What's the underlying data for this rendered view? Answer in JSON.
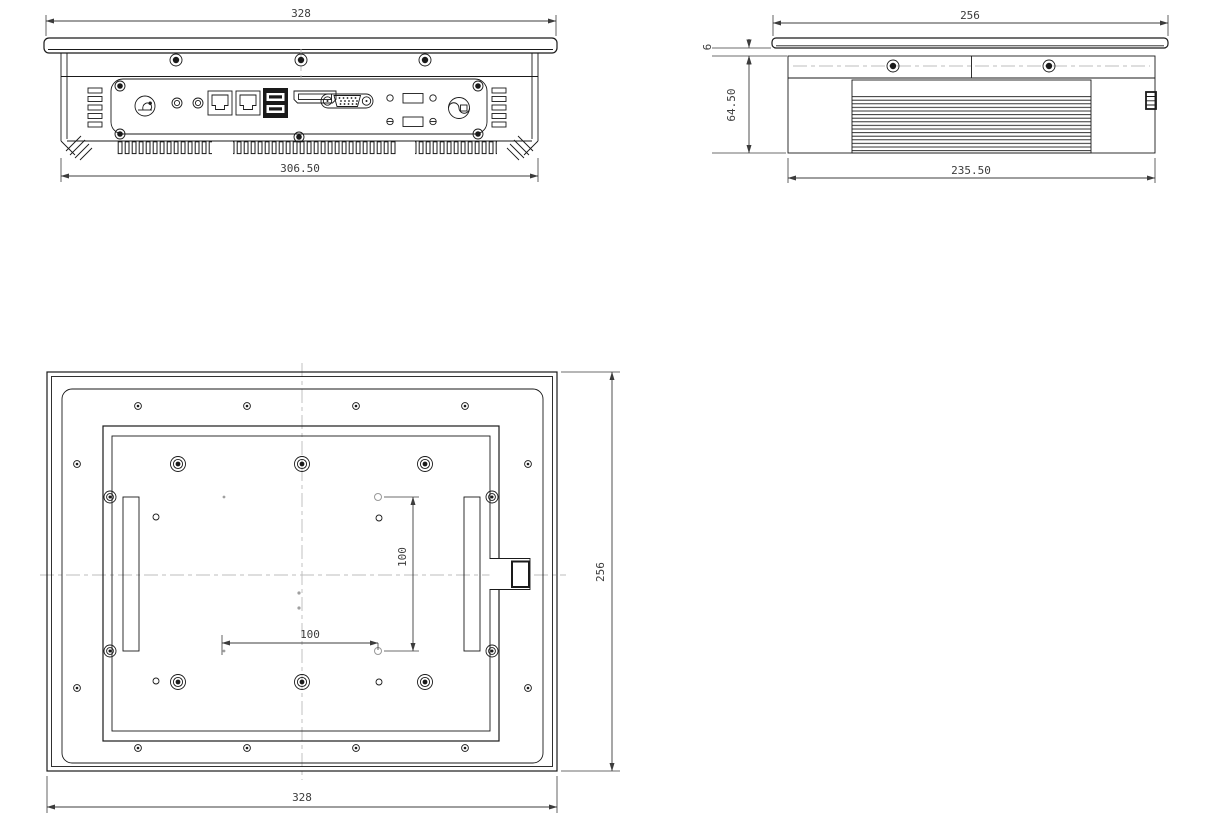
{
  "views": {
    "io_view": {
      "dims": {
        "overall_width": "328",
        "body_width": "306.50"
      },
      "ports": [
        "power-button",
        "audio-jack",
        "audio-jack",
        "lan-port",
        "lan-port",
        "usb-dual-port",
        "hdmi-port",
        "vga-port",
        "antenna-hole",
        "io-cutout",
        "antenna-hole",
        "io-cutout",
        "power-connector"
      ]
    },
    "side_view": {
      "dims": {
        "overall_depth": "256",
        "panel_thickness": "6",
        "body_height": "64.50",
        "body_depth": "235.50"
      }
    },
    "rear_view": {
      "dims": {
        "overall_width": "328",
        "overall_height": "256",
        "vesa_horizontal": "100",
        "vesa_vertical": "100"
      }
    }
  },
  "colors": {
    "line": "#1a1a1a",
    "dim_text": "#3c3c3c",
    "centerline": "#bcbcbc",
    "hole": "#999999",
    "background": "#ffffff"
  }
}
